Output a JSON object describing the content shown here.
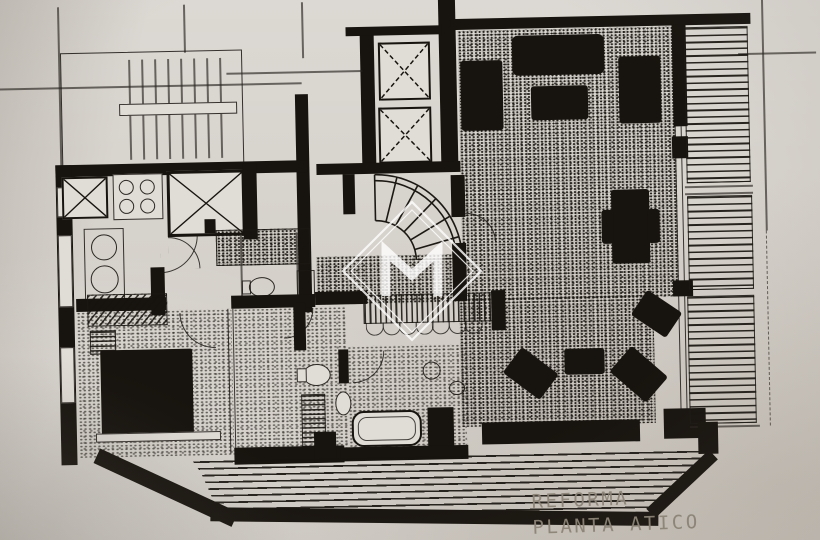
{
  "document": {
    "kind": "scanned architectural floor plan (attic renovation)",
    "caption": {
      "line1": "REFORMA",
      "line2": "PLANTA ATICO"
    }
  },
  "watermark": {
    "icon": "diamond-m-logo"
  },
  "colors": {
    "paper": "#d8d4ce",
    "paper_light": "#e0dcd6",
    "ink": "#17130e",
    "caption_text": "#8d8578",
    "watermark": "#ffffff"
  }
}
